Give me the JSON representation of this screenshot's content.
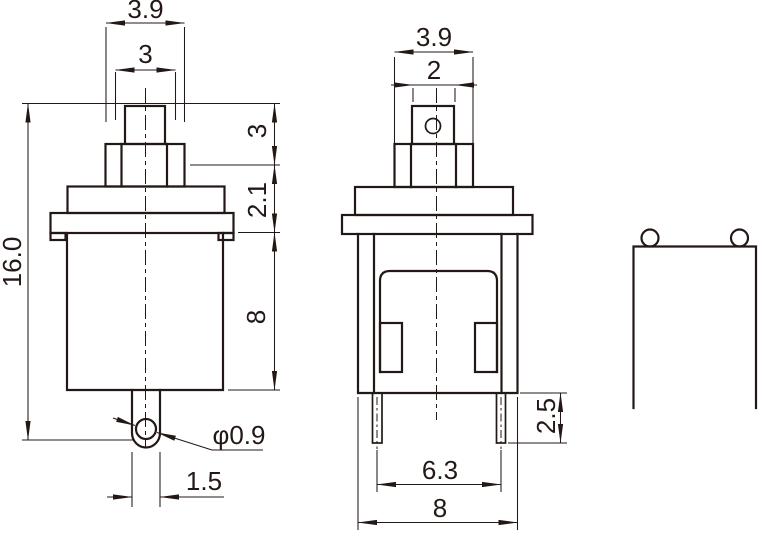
{
  "meta": {
    "type": "engineering-drawing",
    "subject": "push button switch - three orthographic views with dimensions",
    "units": "mm"
  },
  "colors": {
    "line": "#231815",
    "background": "#ffffff"
  },
  "dims": {
    "front": {
      "outer_width": "3.9",
      "tip_width": "3",
      "total_height": "16.0",
      "tip_height": "3",
      "collar_height": "2.1",
      "body_height": "8",
      "hole_diameter": "φ0.9",
      "terminal_width": "1.5"
    },
    "side": {
      "outer_width": "3.9",
      "tip_width": "2",
      "pin_length": "2.5",
      "pin_spacing": "6.3",
      "body_width": "8"
    }
  }
}
